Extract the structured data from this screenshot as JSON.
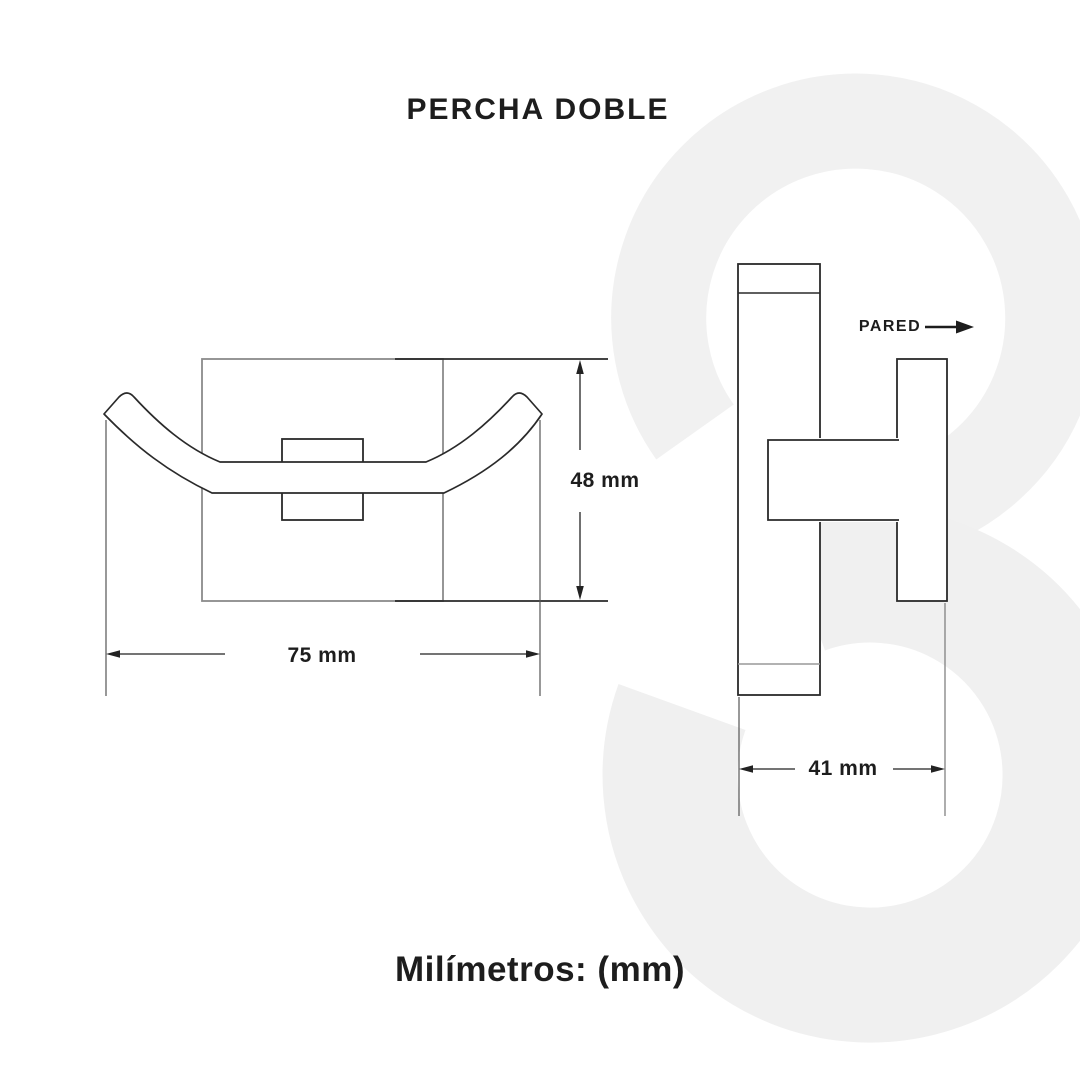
{
  "title": "PERCHA DOBLE",
  "units_note": "Milímetros: (mm)",
  "front_view": {
    "description": "front view of double hook with square back plate",
    "width_dim": "75 mm",
    "height_dim": "48 mm"
  },
  "side_view": {
    "description": "side profile view mounted to wall",
    "depth_dim": "41 mm",
    "wall_label": "PARED"
  },
  "colors": {
    "primary_line": "#2a2a2a",
    "secondary_line": "#8a8a8a",
    "extension_line": "#555555",
    "text": "#1d1d1d",
    "watermark": "#f1f1f1",
    "background": "#ffffff"
  }
}
